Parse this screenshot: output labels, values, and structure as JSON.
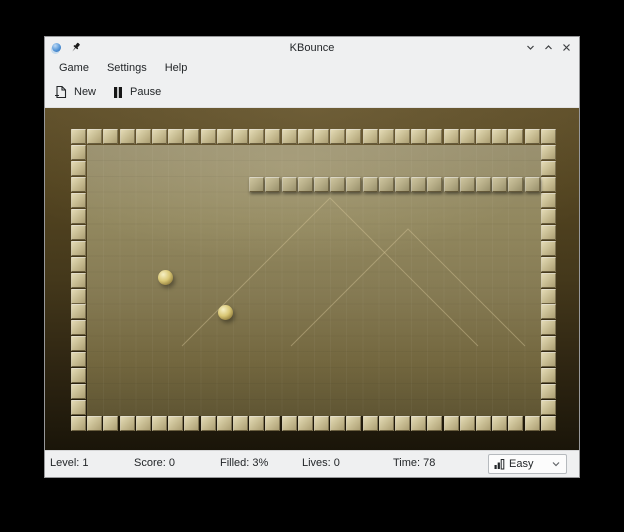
{
  "window": {
    "title": "KBounce"
  },
  "menubar": {
    "items": [
      {
        "label": "Game"
      },
      {
        "label": "Settings"
      },
      {
        "label": "Help"
      }
    ]
  },
  "toolbar": {
    "new_label": "New",
    "pause_label": "Pause"
  },
  "game": {
    "board": {
      "cols": 30,
      "rows": 19,
      "origin_x": 26,
      "origin_y": 21,
      "pitch_x": 16.2,
      "pitch_y": 15.95
    },
    "walls": [
      {
        "row": 3,
        "col_start": 11,
        "col_end": 28
      }
    ],
    "balls": [
      {
        "x": 120,
        "y": 169,
        "d": 15
      },
      {
        "x": 180,
        "y": 204,
        "d": 15
      }
    ],
    "colors": {
      "border_tile_face": "#cbc096",
      "border_tile_hi": "#e3dab5",
      "border_tile_lo": "#ac9f74",
      "wall_tile_face": "#b8af89",
      "wall_tile_hi": "#cdc49e",
      "wall_tile_lo": "#99906b",
      "field_line": "rgba(216,201,156,0.42)",
      "ball_hi": "#f6f0c4",
      "ball_mid": "#d9c775",
      "ball_lo": "#8a7636"
    }
  },
  "statusbar": {
    "level_label": "Level: 1",
    "score_label": "Score: 0",
    "filled_label": "Filled: 3%",
    "lives_label": "Lives: 0",
    "time_label": "Time: 78",
    "difficulty": {
      "value": "Easy"
    }
  }
}
